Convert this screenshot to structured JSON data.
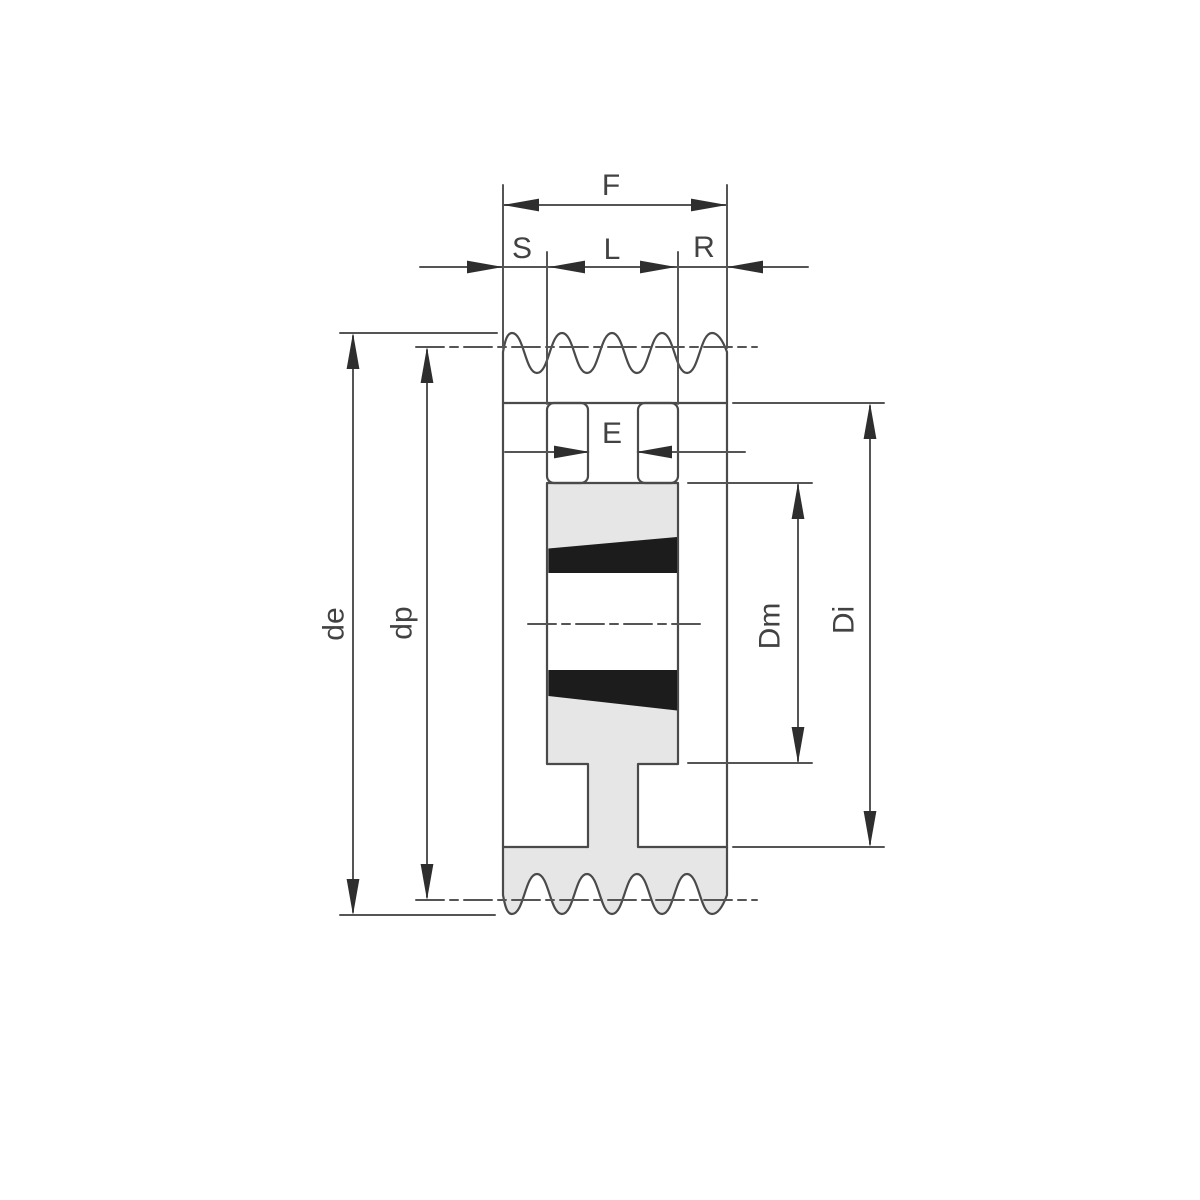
{
  "drawing": {
    "labels": {
      "f": "F",
      "s": "S",
      "l": "L",
      "r": "R",
      "e": "E",
      "de": "de",
      "dp": "dp",
      "dm": "Dm",
      "di": "Di"
    },
    "colors": {
      "line": "#4a4a4a",
      "body_fill": "#e6e6e6",
      "bushing_fill": "#1c1c1c",
      "label_text": "#424242",
      "background": "#ffffff"
    }
  }
}
